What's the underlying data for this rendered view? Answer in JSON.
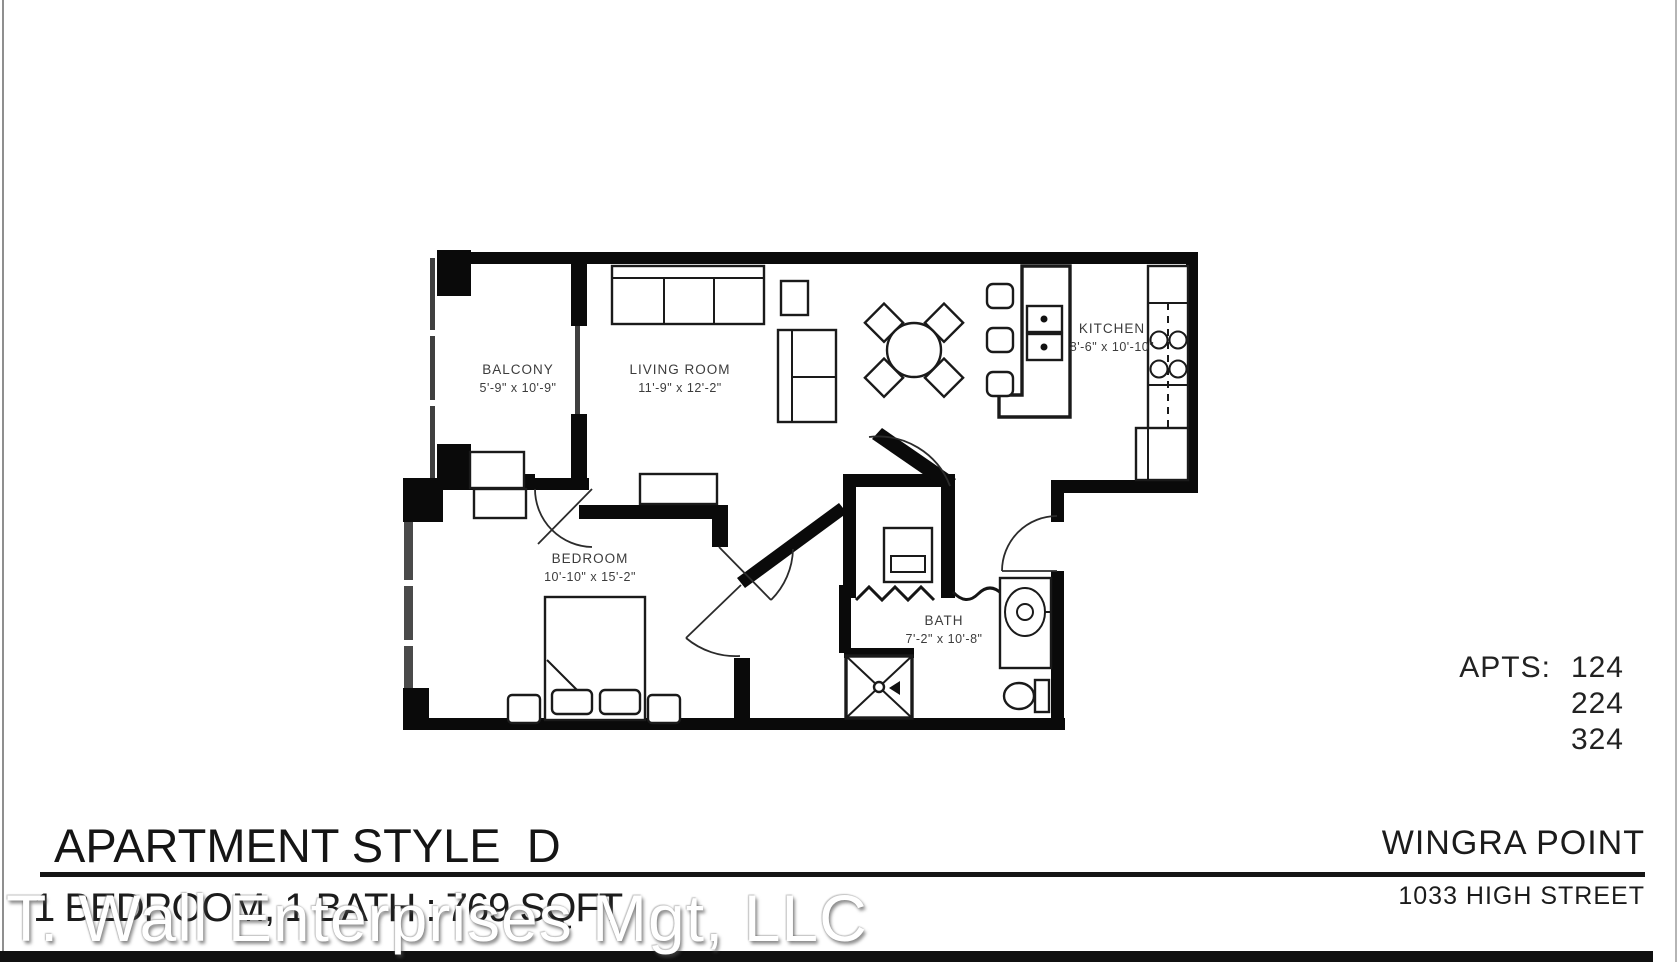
{
  "document": {
    "footer": {
      "title": "APARTMENT STYLE  D",
      "subtitle": "1 BEDROOM, 1 BATH : 769 SQFT",
      "property_name": "WINGRA POINT",
      "address": "1033 HIGH STREET"
    },
    "apartments": {
      "label": "APTS:",
      "numbers": [
        "124",
        "224",
        "324"
      ]
    },
    "watermark": "T. Wall Enterprises Mgt, LLC",
    "colors": {
      "ink": "#111111",
      "wall": "#0a0a0a",
      "label_text": "#3c3c3c",
      "watermark_fill": "#ffffff"
    }
  },
  "plan": {
    "rooms": [
      {
        "name": "BALCONY",
        "dims": "5'-9\" x 10'-9\""
      },
      {
        "name": "LIVING ROOM",
        "dims": "11'-9\" x 12'-2\""
      },
      {
        "name": "KITCHEN",
        "dims": "8'-6\" x 10'-10\""
      },
      {
        "name": "BEDROOM",
        "dims": "10'-10\" x 15'-2\""
      },
      {
        "name": "BATH",
        "dims": "7'-2\" x 10'-8\""
      }
    ]
  }
}
